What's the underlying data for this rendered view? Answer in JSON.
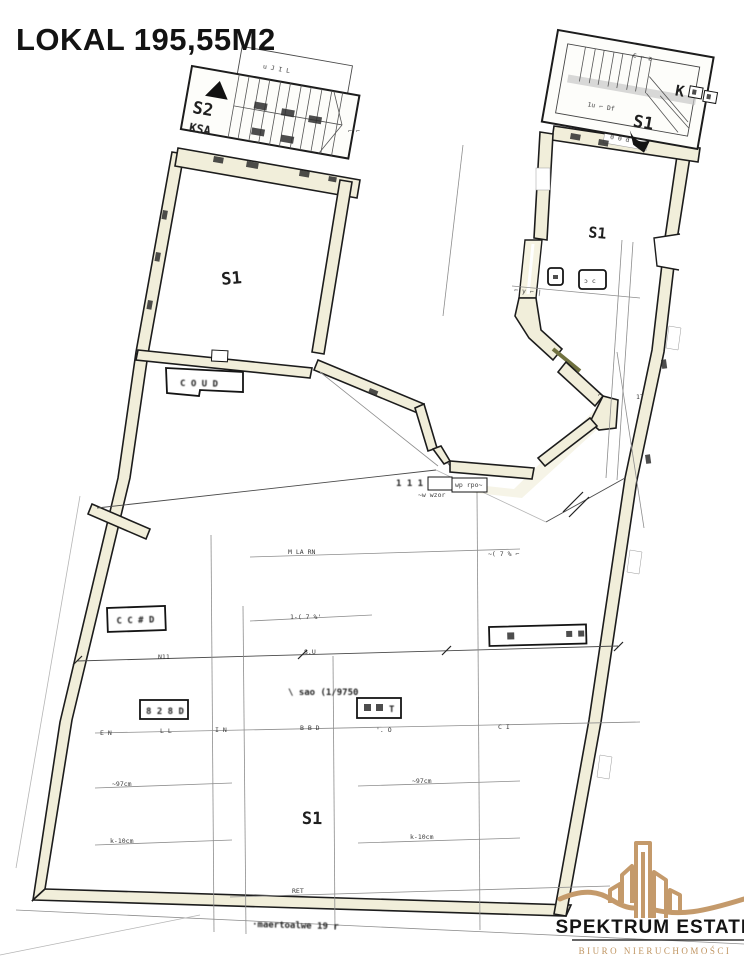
{
  "title": "LOKAL 195,55M2",
  "labels": {
    "stair_left": "S2",
    "stair_left_sub": "KSA",
    "stair_right": "S1",
    "stair_right_k": "K",
    "room_left": "S1",
    "room_right": "S1",
    "room_bottom": "S1"
  },
  "boxes": {
    "coud": "C O U D",
    "left_box": "C C # D",
    "lower_box": "8 2 8 D",
    "squares_box_t": "T",
    "dim_box": "wp rpo~"
  },
  "ann": [
    "u J  I L",
    "⌐ ⌐",
    "€ ⌐ z",
    "1u ⌐ Df",
    "0 0 d",
    "⌐ y ⌐ |",
    "17",
    "1 1 1 3 6",
    "~w wzor",
    "M LA RN",
    "~( 7 % ⌐",
    "1-( 7 %'",
    "N11",
    "8.U",
    "\\ sao (1/9750",
    "E N",
    "L L",
    "I N",
    "B B D",
    "'. O",
    "C I",
    "~97cm",
    "~97cm",
    "k-10cm",
    "k-10cm",
    "RET",
    "·maertoalwe 19 r",
    "⌐"
  ],
  "logo": {
    "name": "SPEKTRUM ESTATE",
    "subtitle": "BIURO NIERUCHOMOŚCI"
  },
  "colors": {
    "wall_fill": "#f1eeda",
    "ink": "#1c1c1c",
    "logo_gold": "#c49a6b",
    "logo_subtitle_gold": "#bf9460"
  }
}
